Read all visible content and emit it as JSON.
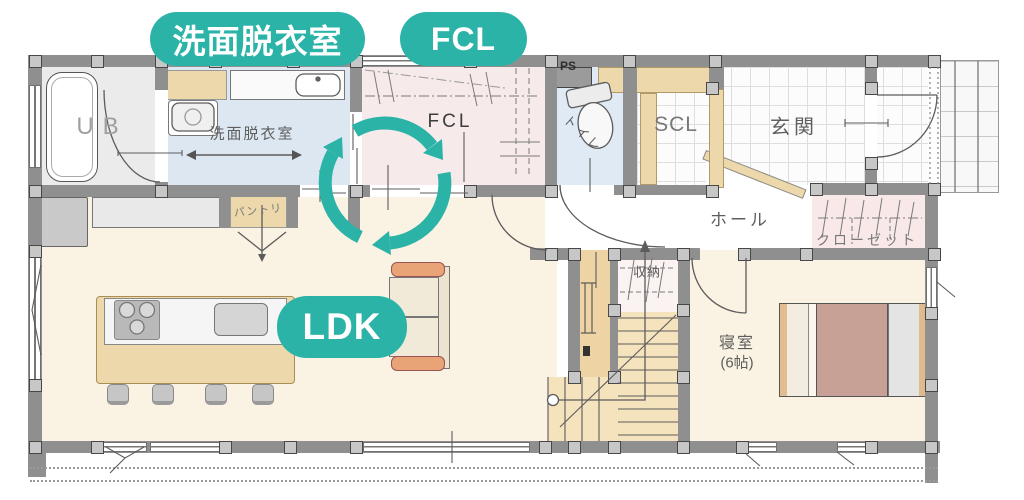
{
  "badges": {
    "washroom": "洗面脱衣室",
    "fcl": "FCL",
    "ldk": "LDK"
  },
  "rooms": {
    "ub": "UB",
    "washroom": "洗面脱衣室",
    "fcl": "FCL",
    "ps": "PS",
    "toilet": "トイレ",
    "scl": "SCL",
    "genkan": "玄関",
    "hall": "ホール",
    "closet": "クローゼット",
    "storage": "収納",
    "bedroom_name": "寝室",
    "bedroom_size": "(6帖)",
    "pantry": "パントリ"
  },
  "icons": {
    "flow_cycle": "circular-flow-arrows-icon"
  },
  "colors": {
    "accent_teal": "#2bb3a8",
    "wall_grey": "#8f8f8f",
    "floor_cream": "#faf2e2",
    "floor_blue": "#dce7f2",
    "floor_pink": "#f6ebea",
    "wood_beige": "#ecd8ab",
    "bed_blanket": "#c8a196",
    "sofa_arm": "#e8a377"
  }
}
